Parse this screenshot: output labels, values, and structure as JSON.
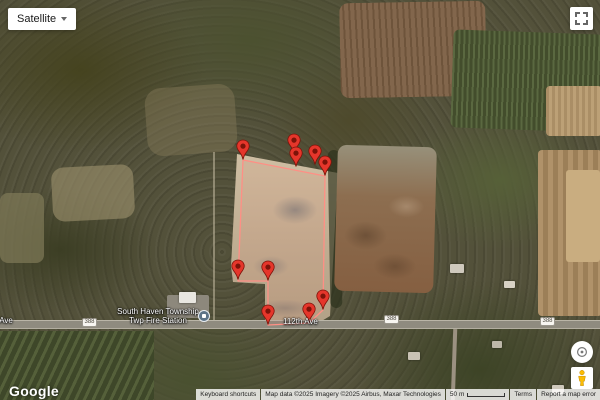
{
  "controls": {
    "map_type": "Satellite",
    "icons": {
      "map_type_caret": "caret-down",
      "fullscreen": "fullscreen-corners",
      "rotate_control": "compass-rotate",
      "street_view": "pegman",
      "marker": "red-map-pin",
      "poi": "civic-building-circle"
    }
  },
  "branding": {
    "logo": "Google"
  },
  "attribution": {
    "keyboard": "Keyboard shortcuts",
    "map_data": "Map data ©2025 Imagery ©2025 Airbus, Maxar Technologies",
    "scale": "50 m",
    "terms": "Terms",
    "report": "Report a map error"
  },
  "map": {
    "view": "satellite",
    "poi": {
      "line1": "South Haven Township",
      "line2": "Twp Fire Station"
    },
    "road_labels": [
      {
        "text": "112th Ave",
        "x": -22,
        "y": 316
      },
      {
        "text": "112th Ave",
        "x": 283,
        "y": 317
      }
    ],
    "route_shields": [
      {
        "text": "388",
        "x": 82,
        "y": 318
      },
      {
        "text": "388",
        "x": 384,
        "y": 315
      },
      {
        "text": "388",
        "x": 540,
        "y": 317
      }
    ],
    "markers": [
      [
        243,
        160
      ],
      [
        294,
        154
      ],
      [
        296,
        167
      ],
      [
        315,
        165
      ],
      [
        325,
        176
      ],
      [
        238,
        280
      ],
      [
        268,
        281
      ],
      [
        268,
        325
      ],
      [
        309,
        323
      ],
      [
        323,
        310
      ]
    ],
    "boundary": {
      "points": "243,160 325,176 323,310 309,323 268,325 268,281 238,281 243,160",
      "stroke": "#ff8f85",
      "fill": "rgba(255,70,50,0.06)"
    },
    "colors": {
      "marker": "#e5362b",
      "marker_dark": "#7c1309",
      "poi_icon_bg": "#5c7387"
    }
  }
}
